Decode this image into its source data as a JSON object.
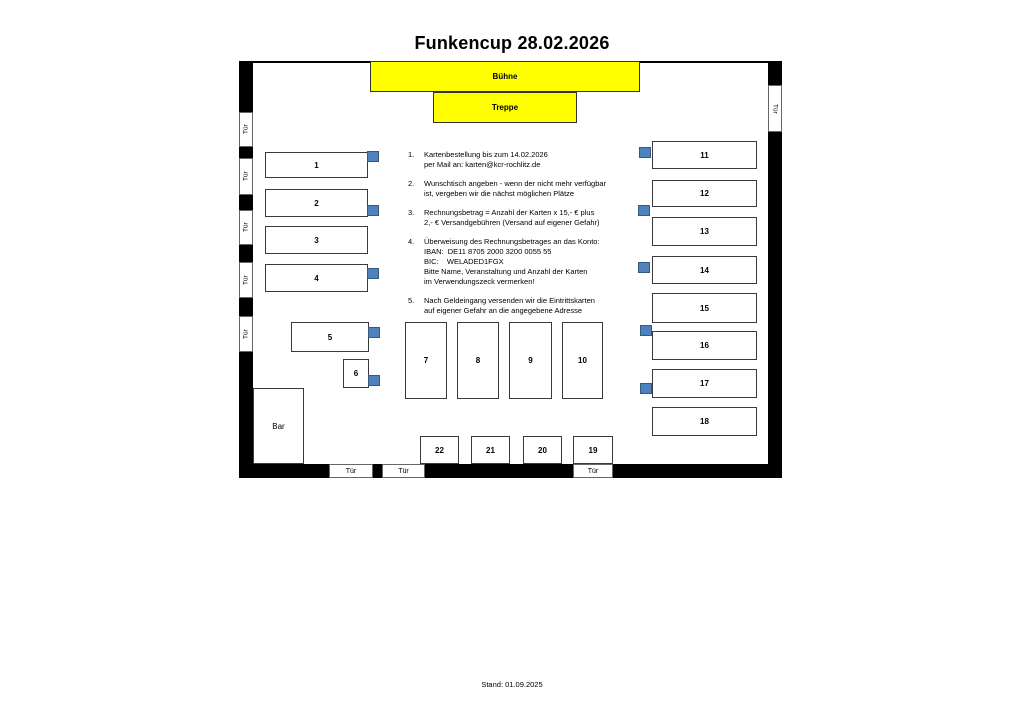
{
  "page": {
    "title": "Funkencup 28.02.2026",
    "footer": "Stand: 01.09.2025"
  },
  "floor_plan": {
    "stage_label": "Bühne",
    "stairs_label": "Treppe",
    "bar_label": "Bar",
    "door_label": "Tür",
    "tables": [
      {
        "label": "1"
      },
      {
        "label": "2"
      },
      {
        "label": "3"
      },
      {
        "label": "4"
      },
      {
        "label": "5"
      },
      {
        "label": "6"
      },
      {
        "label": "7"
      },
      {
        "label": "8"
      },
      {
        "label": "9"
      },
      {
        "label": "10"
      },
      {
        "label": "11"
      },
      {
        "label": "12"
      },
      {
        "label": "13"
      },
      {
        "label": "14"
      },
      {
        "label": "15"
      },
      {
        "label": "16"
      },
      {
        "label": "17"
      },
      {
        "label": "18"
      },
      {
        "label": "19"
      },
      {
        "label": "20"
      },
      {
        "label": "21"
      },
      {
        "label": "22"
      }
    ],
    "colors": {
      "stage_yellow": "#FFFF00",
      "marker_blue": "#4F81BD",
      "marker_blue_border": "#36597F",
      "wall_black": "#000000"
    }
  },
  "instructions": {
    "items": [
      {
        "num": "1.",
        "text": "Kartenbestellung bis zum 14.02.2026\nper Mail an: karten@kcr-rochlitz.de"
      },
      {
        "num": "2.",
        "text": "Wunschtisch angeben - wenn der nicht mehr verfügbar\nist, vergeben wir die nächst möglichen Plätze"
      },
      {
        "num": "3.",
        "text": "Rechnungsbetrag = Anzahl der Karten x 15,- € plus\n2,- € Versandgebühren (Versand auf eigener Gefahr)"
      },
      {
        "num": "4.",
        "text": "Überweisung des Rechnungsbetrages an das Konto:\nIBAN:  DE11 8705 2000 3200 0055 55\nBIC:    WELADED1FGX\nBitte Name, Veranstaltung und Anzahl der Karten\nim Verwendungszeck vermerken!"
      },
      {
        "num": "5.",
        "text": "Nach Geldeingang versenden wir die Eintrittskarten\nauf eigener Gefahr an die angegebene Adresse"
      }
    ]
  }
}
